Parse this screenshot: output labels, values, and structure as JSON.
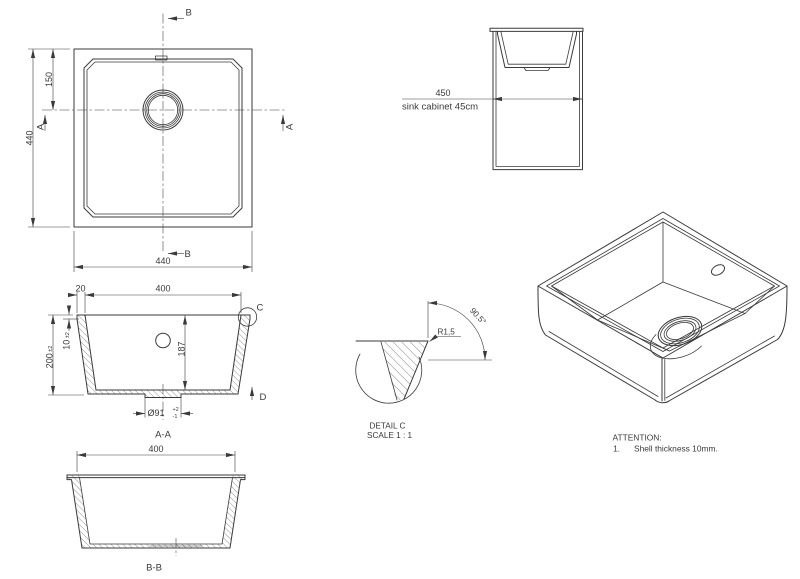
{
  "drawing": {
    "colors": {
      "line": "#3a3a3a",
      "background": "#ffffff"
    },
    "top_view": {
      "marker_b": "B",
      "marker_a": "A",
      "dim_height": "440",
      "dim_drain_offset": "150",
      "dim_width": "440"
    },
    "cabinet_view": {
      "dim_width": "450",
      "caption": "sink cabinet 45cm"
    },
    "section_aa": {
      "label": "A-A",
      "dim_rim": "20",
      "dim_inner_width": "400",
      "dim_height": "200",
      "dim_height_tol": "±2",
      "dim_rim_thickness": "10",
      "dim_rim_thickness_tol": "±2",
      "dim_depth": "187",
      "dim_drain": "Ø91",
      "dim_drain_tol_plus": "+2",
      "dim_drain_tol_minus": "-1",
      "detail_marker": "C",
      "direction_marker": "D"
    },
    "section_bb": {
      "label": "B-B",
      "dim_width": "400"
    },
    "detail_c": {
      "angle": "90.5°",
      "radius": "R1,5",
      "title": "DETAIL C",
      "scale": "SCALE 1 : 1"
    },
    "attention": {
      "title": "ATTENTION:",
      "item_number": "1.",
      "item_text": "Shell thickness 10mm."
    }
  }
}
